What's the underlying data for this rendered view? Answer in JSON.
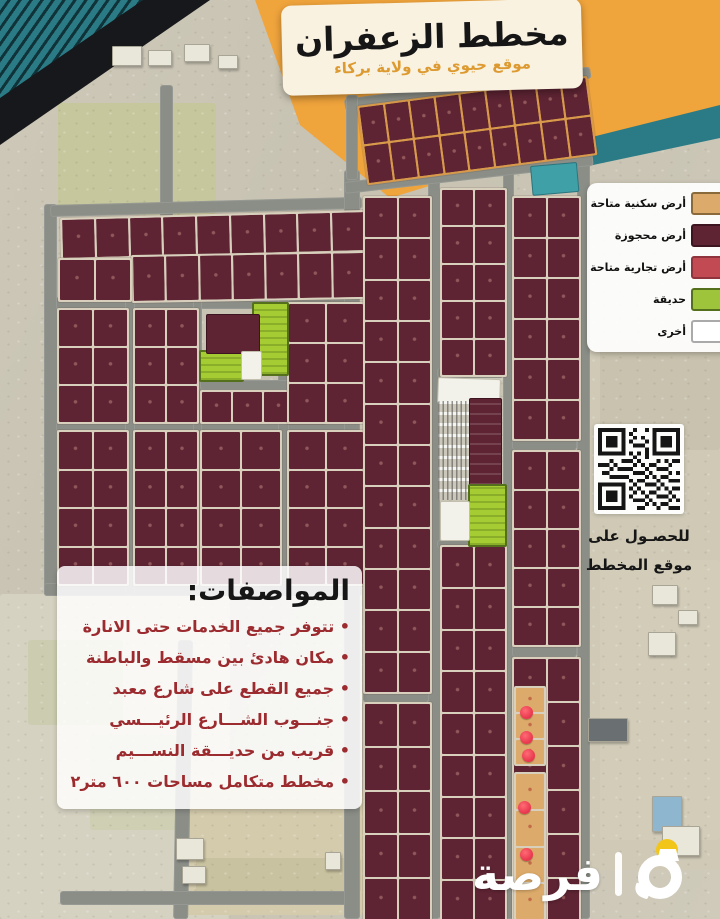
{
  "banner": {
    "title": "مخطط الزعفران",
    "subtitle": "موقع حيوي في ولاية بركاء"
  },
  "legend": {
    "items": [
      {
        "label": "أرض سكنية متاحة",
        "color": "#dcab6b",
        "border": "#8a6a3a"
      },
      {
        "label": "أرض محجوزة",
        "color": "#5e2433",
        "border": "#3c1520"
      },
      {
        "label": "أرض تجارية متاحة",
        "color": "#c24a52",
        "border": "#8f333c"
      },
      {
        "label": "حديقة",
        "color": "#9ec43b",
        "border": "#55701d"
      },
      {
        "label": "أخرى",
        "color": "#ffffff",
        "border": "#aaaaaa"
      }
    ]
  },
  "qr": {
    "caption_line1": "للحصـول على",
    "caption_line2": "موقع المخطط"
  },
  "specs": {
    "title": "المواصفات:",
    "items": [
      "تتوفر جميع الخدمات حتى الانارة",
      "مكان هادئ بين مسقط والباطنة",
      "جميع القطع على شارع معبد",
      "جنـــوب الشـــارع الرئيـــسي",
      "قريب من حديـــقة النســـيم",
      "مخطط متكامل مساحات ٦٠٠ متر٢"
    ]
  },
  "logo": {
    "name": "فرصة"
  },
  "map": {
    "colors": {
      "terrain": "#c7c2b2",
      "street": "#8b8e87",
      "reserved": "#5e2433",
      "residential": "#dcab6b",
      "commercial": "#c24a52",
      "park": "#a5cc33",
      "other": "#f2f1ea",
      "teal_plot": "#3fa0a8",
      "orange_corner": "#f0a43c",
      "teal_corner": "#2a7b85",
      "stamp": "#e8354d"
    },
    "fields": [
      {
        "r": [
          58,
          103,
          158,
          112
        ],
        "c": "#c6c79c",
        "p": "trees"
      },
      {
        "r": [
          0,
          594,
          230,
          325
        ],
        "c": "#d6d2c2",
        "p": ""
      },
      {
        "r": [
          28,
          640,
          95,
          85
        ],
        "c": "#ccccb0",
        "p": ""
      },
      {
        "r": [
          90,
          735,
          90,
          95
        ],
        "c": "#cfcfb4",
        "p": ""
      },
      {
        "r": [
          185,
          790,
          178,
          125
        ],
        "c": "#d4cbac",
        "p": ""
      },
      {
        "r": [
          196,
          858,
          165,
          34
        ],
        "c": "#c9c2a0",
        "p": "orchard"
      },
      {
        "r": [
          585,
          225,
          135,
          645
        ],
        "c": "#cfc9b6",
        "p": ""
      },
      {
        "r": [
          600,
          340,
          120,
          110
        ],
        "c": "#c8c2ae",
        "p": "trees"
      },
      {
        "r": [
          600,
          560,
          120,
          280
        ],
        "c": "#d2ccb9",
        "p": "trees"
      }
    ],
    "streets": [
      [
        160,
        85,
        13,
        165,
        0
      ],
      [
        178,
        640,
        15,
        279,
        1
      ],
      [
        60,
        891,
        300,
        14,
        0
      ],
      [
        44,
        204,
        13,
        392,
        0
      ],
      [
        44,
        583,
        318,
        13,
        0
      ],
      [
        50,
        205,
        312,
        12,
        -1.5
      ],
      [
        56,
        297,
        300,
        12,
        0
      ],
      [
        56,
        419,
        300,
        12,
        0
      ],
      [
        125,
        297,
        10,
        298,
        0
      ],
      [
        193,
        297,
        9,
        298,
        0
      ],
      [
        278,
        297,
        11,
        298,
        0
      ],
      [
        344,
        170,
        16,
        749,
        0
      ],
      [
        428,
        170,
        12,
        749,
        0
      ],
      [
        503,
        165,
        11,
        754,
        0
      ],
      [
        577,
        160,
        13,
        759,
        0
      ],
      [
        344,
        182,
        250,
        12,
        -6.5
      ],
      [
        344,
        99,
        248,
        12,
        -7.5
      ],
      [
        346,
        95,
        12,
        85,
        0
      ],
      [
        363,
        689,
        66,
        13,
        0
      ],
      [
        512,
        437,
        65,
        13,
        0
      ],
      [
        512,
        643,
        65,
        14,
        0
      ],
      [
        200,
        380,
        125,
        10,
        0
      ],
      [
        437,
        368,
        66,
        10,
        0
      ],
      [
        437,
        540,
        66,
        8,
        0
      ]
    ],
    "blocks": [
      {
        "r": [
          357,
          106,
          228,
          76
        ],
        "rows": 2,
        "cols": 9,
        "rot": -7.5,
        "gap": "o"
      },
      {
        "r": [
          60,
          218,
          302,
          38
        ],
        "rows": 1,
        "cols": 9,
        "rot": -1.5
      },
      {
        "r": [
          131,
          255,
          231,
          44
        ],
        "rows": 1,
        "cols": 7,
        "rot": -1
      },
      {
        "r": [
          58,
          258,
          70,
          40
        ],
        "rows": 1,
        "cols": 2,
        "rot": 0
      },
      {
        "r": [
          57,
          308,
          68,
          112
        ],
        "rows": 3,
        "cols": 2,
        "rot": 0
      },
      {
        "r": [
          57,
          430,
          68,
          152
        ],
        "rows": 4,
        "cols": 2,
        "rot": 0
      },
      {
        "r": [
          133,
          308,
          62,
          112
        ],
        "rows": 3,
        "cols": 2,
        "rot": 0
      },
      {
        "r": [
          133,
          430,
          62,
          152
        ],
        "rows": 4,
        "cols": 2,
        "rot": 0
      },
      {
        "r": [
          200,
          390,
          122,
          30
        ],
        "rows": 1,
        "cols": 4,
        "rot": 0
      },
      {
        "r": [
          200,
          430,
          78,
          152
        ],
        "rows": 4,
        "cols": 2,
        "rot": 0
      },
      {
        "r": [
          287,
          302,
          74,
          118
        ],
        "rows": 3,
        "cols": 2,
        "rot": 0
      },
      {
        "r": [
          287,
          430,
          74,
          152
        ],
        "rows": 4,
        "cols": 2,
        "rot": 0
      },
      {
        "r": [
          363,
          196,
          65,
          494
        ],
        "rows": 12,
        "cols": 2,
        "rot": 0
      },
      {
        "r": [
          363,
          702,
          65,
          217
        ],
        "rows": 5,
        "cols": 2,
        "rot": 0
      },
      {
        "r": [
          440,
          188,
          63,
          185
        ],
        "rows": 5,
        "cols": 2,
        "rot": 0
      },
      {
        "r": [
          440,
          545,
          63,
          374
        ],
        "rows": 9,
        "cols": 2,
        "rot": 0
      },
      {
        "r": [
          512,
          196,
          65,
          241
        ],
        "rows": 6,
        "cols": 2,
        "rot": 0
      },
      {
        "r": [
          512,
          450,
          65,
          193
        ],
        "rows": 5,
        "cols": 2,
        "rot": 0
      },
      {
        "r": [
          512,
          657,
          65,
          262
        ],
        "rows": 6,
        "cols": 2,
        "rot": 0
      },
      {
        "r": [
          514,
          686,
          28,
          76
        ],
        "rows": 3,
        "cols": 1,
        "rot": 0,
        "t": "tan"
      },
      {
        "r": [
          514,
          772,
          28,
          145
        ],
        "rows": 4,
        "cols": 1,
        "rot": 0,
        "t": "tan"
      }
    ],
    "overlays": [
      {
        "r": [
          530,
          166,
          45,
          28
        ],
        "t": "teal",
        "rot": -5
      },
      {
        "r": [
          252,
          302,
          33,
          70
        ],
        "t": "park"
      },
      {
        "r": [
          199,
          350,
          41,
          28
        ],
        "t": "park"
      },
      {
        "r": [
          206,
          314,
          52,
          38
        ],
        "t": "maroon"
      },
      {
        "r": [
          241,
          351,
          19,
          27
        ],
        "t": "white"
      },
      {
        "r": [
          438,
          377,
          61,
          24
        ],
        "t": "white",
        "rot": 2
      },
      {
        "r": [
          438,
          401,
          34,
          99
        ],
        "t": "carpark"
      },
      {
        "r": [
          469,
          398,
          31,
          86
        ],
        "t": "bstrip"
      },
      {
        "r": [
          468,
          484,
          35,
          59
        ],
        "t": "park"
      },
      {
        "r": [
          440,
          501,
          28,
          38
        ],
        "t": "white"
      }
    ],
    "stamps": [
      [
        520,
        706
      ],
      [
        520,
        731
      ],
      [
        522,
        749
      ],
      [
        518,
        801
      ],
      [
        520,
        848
      ]
    ],
    "buildings": [
      [
        112,
        46,
        28,
        18
      ],
      [
        148,
        50,
        22,
        14
      ],
      [
        184,
        44,
        24,
        16
      ],
      [
        218,
        55,
        18,
        12
      ],
      [
        648,
        632,
        26,
        22
      ],
      [
        678,
        610,
        18,
        13
      ],
      [
        652,
        585,
        24,
        18
      ],
      [
        588,
        718,
        38,
        22,
        "#6a6f72"
      ],
      [
        652,
        796,
        28,
        34,
        "#8fb6cf"
      ],
      [
        662,
        826,
        36,
        28
      ],
      [
        176,
        838,
        26,
        20
      ],
      [
        182,
        866,
        22,
        16
      ],
      [
        325,
        852,
        14,
        16
      ]
    ],
    "teal_band": {
      "r": [
        585,
        133,
        150,
        33
      ],
      "rot": -12
    }
  }
}
